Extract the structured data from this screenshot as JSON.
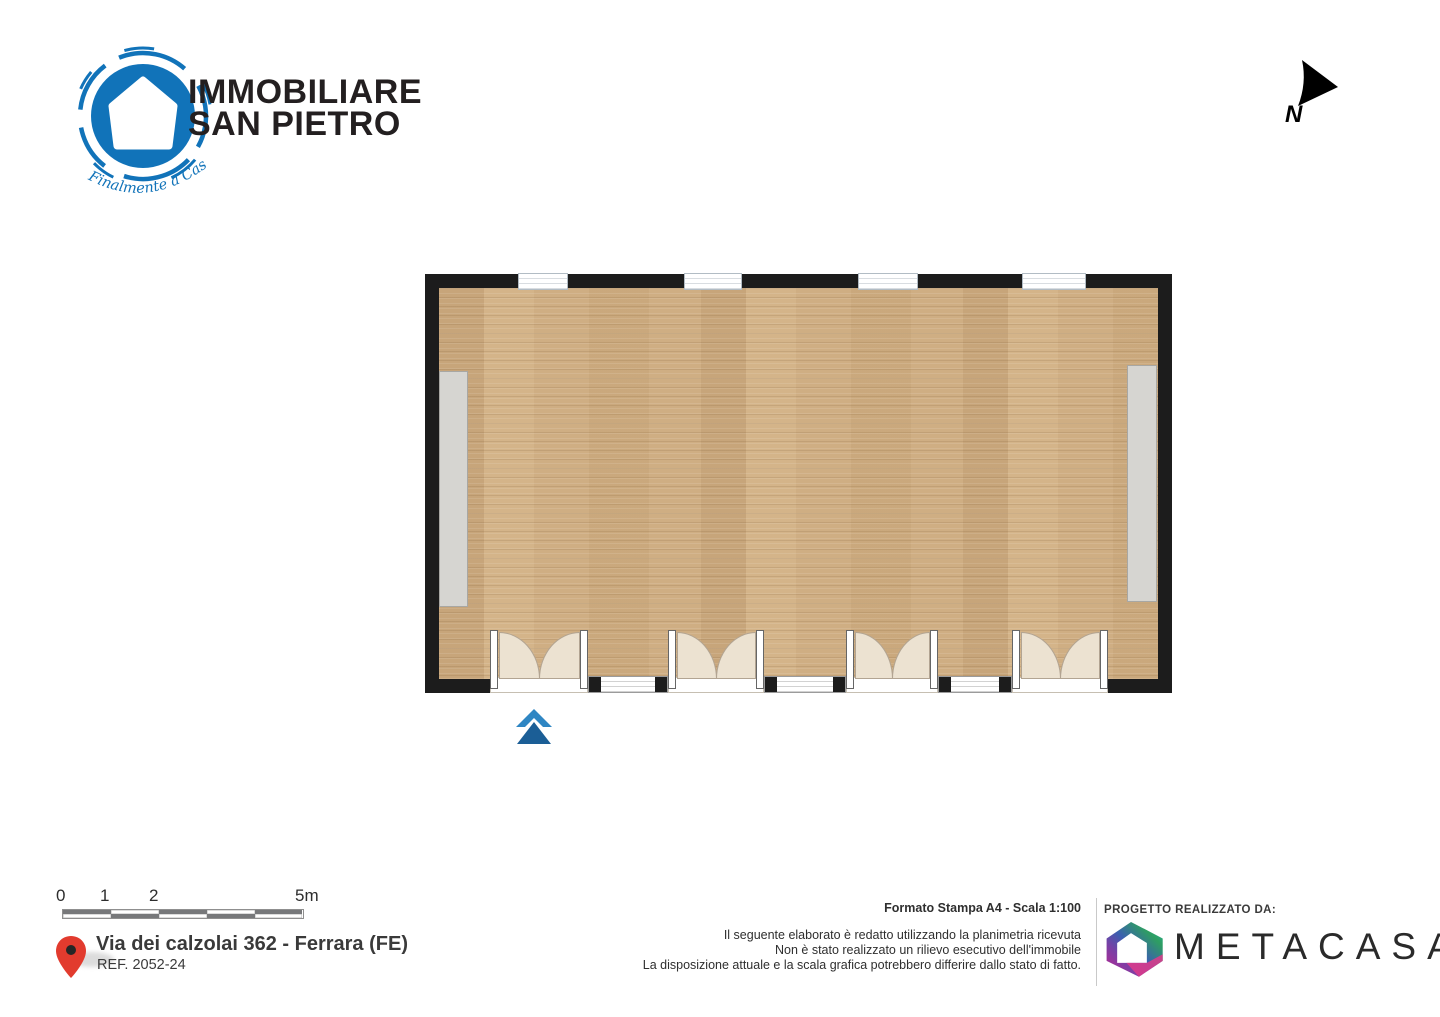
{
  "agency": {
    "name_line1": "IMMOBILIARE",
    "name_line2": "SAN PIETRO",
    "tagline": "Finalmente a Casa",
    "brand_color": "#1173b9"
  },
  "compass": {
    "label": "N"
  },
  "scalebar": {
    "labels": [
      "0",
      "1",
      "2",
      "5m"
    ]
  },
  "location": {
    "address": "Via dei calzolai 362 - Ferrara (FE)",
    "reference": "REF. 2052-24",
    "pin_color": "#e23b2e"
  },
  "print_info": {
    "format_line": "Formato Stampa A4 - Scala 1:100",
    "disclaimer_lines": [
      "Il seguente elaborato è redatto utilizzando la planimetria ricevuta",
      "Non è stato realizzato un rilievo esecutivo dell'immobile",
      "La disposizione attuale e la scala grafica potrebbero differire dallo stato di fatto."
    ]
  },
  "credits": {
    "heading": "PROGETTO REALIZZATO DA:",
    "brand": "METACASA"
  },
  "floorplan": {
    "wall_color": "#1c1c1c",
    "floor_base_color": "#cfae83",
    "cabinet_color": "#d6d5d1",
    "door_leaf_color": "#ece2d1",
    "entrance_arrow_chevron_color": "#2f86c3",
    "entrance_arrow_triangle_color": "#1b5e96",
    "scale_text": "Scala 1:100",
    "windows_top_count": 4,
    "double_doors_bottom_count": 4,
    "windows_bottom_count": 3
  }
}
